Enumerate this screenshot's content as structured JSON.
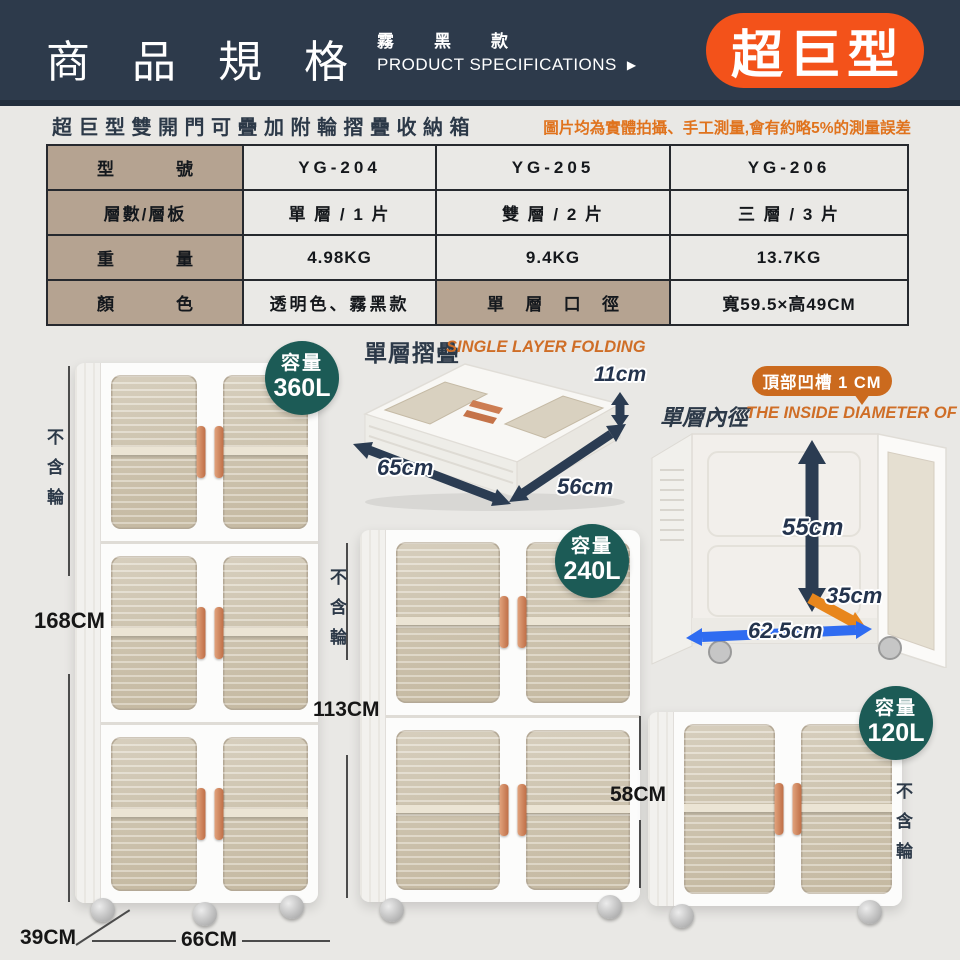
{
  "header": {
    "title": "商品規格",
    "variant": "霧黑款",
    "subtitle": "PRODUCT SPECIFICATIONS",
    "arrow": "▶",
    "badge": "超巨型"
  },
  "intro": {
    "name": "超巨型雙開門可疊加附輪摺疊收納箱",
    "note": "圖片均為實體拍攝、手工測量,會有約略5%的測量誤差"
  },
  "table": {
    "rows": [
      {
        "label": "型號",
        "cells": [
          "YG-204",
          "YG-205",
          "YG-206"
        ]
      },
      {
        "label": "層數/層板",
        "cells": [
          "單 層 / 1 片",
          "雙 層 / 2 片",
          "三 層 / 3 片"
        ]
      },
      {
        "label": "重量",
        "cells": [
          "4.98KG",
          "9.4KG",
          "13.7KG"
        ]
      },
      {
        "label": "顏色",
        "cells": [
          "透明色、霧黑款",
          "單層口徑",
          "寬59.5×高49CM"
        ]
      }
    ]
  },
  "folding": {
    "title_cn": "單層摺疊",
    "title_en": "SINGLE LAYER FOLDING",
    "dim_height": "11cm",
    "dim_width": "65cm",
    "dim_depth": "56cm"
  },
  "inside": {
    "title_cn": "單層內徑",
    "title_en": "THE INSIDE DIAMETER OF",
    "groove": "頂部凹槽 1 CM",
    "dim_height": "55cm",
    "dim_depth": "35cm",
    "dim_width": "62.5cm"
  },
  "products": {
    "tall": {
      "cap_label": "容量",
      "cap": "360L",
      "height": "168CM",
      "no_wheels": "不含輪",
      "depth": "39CM",
      "width": "66CM"
    },
    "medium": {
      "cap_label": "容量",
      "cap": "240L",
      "height": "113CM",
      "no_wheels": "不含輪"
    },
    "small": {
      "cap_label": "容量",
      "cap": "120L",
      "height": "58CM",
      "no_wheels": "不含輪"
    }
  },
  "colors": {
    "header_bg": "#2d3a4b",
    "badge_orange": "#f3521a",
    "note_orange": "#e0731d",
    "title_en_orange": "#cf6e27",
    "groove_badge_orange": "#cb6a1e",
    "capacity_teal": "#1c5b56",
    "table_label_tan": "#b5a391",
    "navy_text": "#2c3948",
    "arrow_navy": "#2b3c52",
    "arrow_orange": "#e8861c",
    "arrow_blue": "#2f6cf1",
    "handle_copper": "#c87a52"
  }
}
